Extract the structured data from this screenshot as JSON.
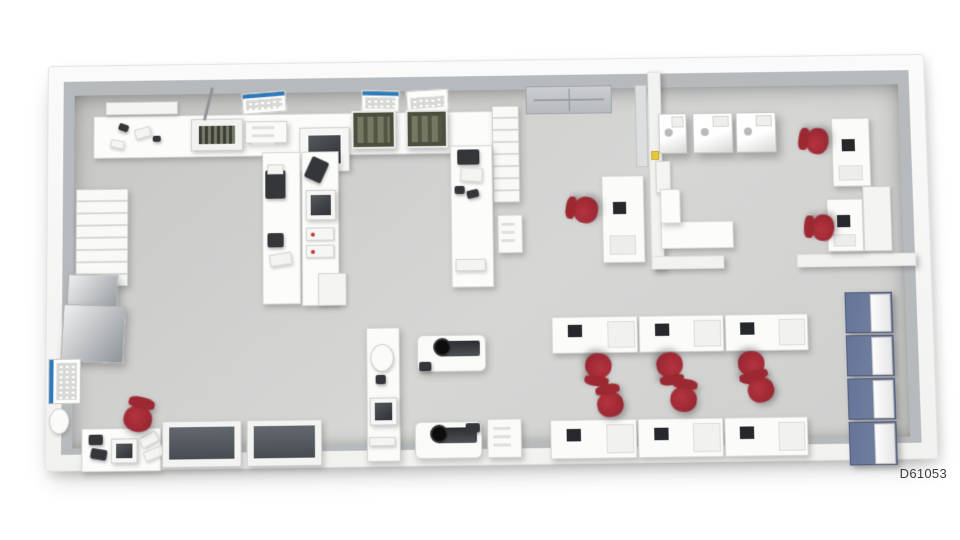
{
  "figure": {
    "id_label": "D61053"
  },
  "palette": {
    "background": "#ffffff",
    "wall_face": "#b7babc",
    "floor_light": "#d6d6d5",
    "floor_dark": "#c7c7c6",
    "chair_red": "#8e222c",
    "locker_blue": "#66749a",
    "poster_blue": "#2f79b8",
    "equipment_dark": "#34363a",
    "machine_olive": "#4c4e3f"
  },
  "floorplan": {
    "items": [
      {
        "n": "top-wall-counter",
        "t": "counter",
        "x": 45,
        "y": 50,
        "w": 400,
        "h": 42
      },
      {
        "n": "wall-shelf",
        "t": "light",
        "x": 57,
        "y": 36,
        "w": 72,
        "h": 13
      },
      {
        "n": "hand-tool",
        "t": "dark",
        "x": 70,
        "y": 58,
        "w": 10,
        "h": 7,
        "r": 20
      },
      {
        "n": "tray-small",
        "t": "light",
        "x": 86,
        "y": 62,
        "w": 16,
        "h": 10,
        "r": -15
      },
      {
        "n": "hand-tool-2",
        "t": "dark",
        "x": 104,
        "y": 70,
        "w": 8,
        "h": 6
      },
      {
        "n": "tray-small-2",
        "t": "light",
        "x": 62,
        "y": 74,
        "w": 14,
        "h": 8,
        "r": 12
      },
      {
        "n": "grill-machine",
        "t": "grill",
        "x": 142,
        "y": 54,
        "w": 52,
        "h": 32
      },
      {
        "n": "stand-pole",
        "t": "pole",
        "x": 158,
        "y": 22,
        "w": 3,
        "h": 34,
        "r": 14
      },
      {
        "n": "tray-box",
        "t": "cart",
        "x": 196,
        "y": 57,
        "w": 42,
        "h": 22
      },
      {
        "n": "steam-cleaner",
        "t": "sqdev",
        "x": 250,
        "y": 64,
        "w": 50,
        "h": 44
      },
      {
        "n": "wall-poster-1",
        "t": "poster",
        "x": 193,
        "y": 28,
        "w": 44,
        "h": 21,
        "r": -4
      },
      {
        "n": "wall-poster-2",
        "t": "poster",
        "x": 312,
        "y": 28,
        "w": 38,
        "h": 22,
        "r": 2
      },
      {
        "n": "wall-poster-3",
        "t": "poster",
        "x": 357,
        "y": 28,
        "w": 42,
        "h": 22,
        "r": -3,
        "c": "transparent"
      },
      {
        "n": "olive-machine-1",
        "t": "olive",
        "x": 302,
        "y": 48,
        "w": 44,
        "h": 38
      },
      {
        "n": "olive-machine-2",
        "t": "olive",
        "x": 356,
        "y": 48,
        "w": 42,
        "h": 38
      },
      {
        "n": "supply-rack",
        "t": "rack",
        "x": 442,
        "y": 45,
        "w": 27,
        "h": 96
      },
      {
        "n": "supply-cart",
        "t": "cart",
        "x": 446,
        "y": 153,
        "w": 25,
        "h": 38
      },
      {
        "n": "entry-door",
        "t": "door",
        "x": 476,
        "y": 26,
        "w": 86,
        "h": 28
      },
      {
        "n": "peninsula-bench-1",
        "t": "bench",
        "x": 213,
        "y": 88,
        "w": 38,
        "h": 150
      },
      {
        "n": "peninsula-bench-2",
        "t": "bench",
        "x": 252,
        "y": 88,
        "w": 37,
        "h": 152
      },
      {
        "n": "press-machine",
        "t": "dark",
        "x": 216,
        "y": 106,
        "w": 20,
        "h": 28
      },
      {
        "n": "press-top",
        "t": "light",
        "x": 218,
        "y": 100,
        "w": 16,
        "h": 10
      },
      {
        "n": "microscope",
        "t": "dark",
        "x": 218,
        "y": 168,
        "w": 16,
        "h": 14
      },
      {
        "n": "work-tray",
        "t": "light",
        "x": 220,
        "y": 188,
        "w": 22,
        "h": 12,
        "r": -8
      },
      {
        "n": "flask-device",
        "t": "sqdev",
        "x": 256,
        "y": 126,
        "w": 30,
        "h": 30
      },
      {
        "n": "small-unit-1",
        "t": "unit",
        "x": 256,
        "y": 163,
        "w": 28,
        "h": 13
      },
      {
        "n": "small-unit-2",
        "t": "unit",
        "x": 256,
        "y": 180,
        "w": 28,
        "h": 13
      },
      {
        "n": "bench-lamp",
        "t": "dark",
        "x": 258,
        "y": 95,
        "w": 18,
        "h": 22,
        "r": 25
      },
      {
        "n": "end-table",
        "t": "light",
        "x": 268,
        "y": 208,
        "w": 28,
        "h": 32
      },
      {
        "n": "peninsula-bench-3",
        "t": "bench",
        "x": 400,
        "y": 84,
        "w": 42,
        "h": 140
      },
      {
        "n": "tablet",
        "t": "dark",
        "x": 407,
        "y": 88,
        "w": 22,
        "h": 15
      },
      {
        "n": "note-sheet",
        "t": "light",
        "x": 410,
        "y": 106,
        "w": 22,
        "h": 14,
        "r": 4
      },
      {
        "n": "tool-small",
        "t": "dark",
        "x": 404,
        "y": 124,
        "w": 10,
        "h": 8
      },
      {
        "n": "tool-small-2",
        "t": "dark",
        "x": 416,
        "y": 128,
        "w": 12,
        "h": 8,
        "r": -12
      },
      {
        "n": "work-tray-2",
        "t": "light",
        "x": 404,
        "y": 196,
        "w": 30,
        "h": 12
      },
      {
        "n": "wall-cabinet-shelves",
        "t": "rack",
        "x": 28,
        "y": 122,
        "w": 52,
        "h": 96
      },
      {
        "n": "steel-cabinet-1",
        "t": "graybox",
        "x": 20,
        "y": 206,
        "w": 50,
        "h": 44,
        "r": 2
      },
      {
        "n": "steel-cabinet-2",
        "t": "graybox",
        "x": 15,
        "y": 236,
        "w": 62,
        "h": 56,
        "r": 3
      },
      {
        "n": "side-wall-poster",
        "t": "posterside",
        "x": 2,
        "y": 288,
        "w": 32,
        "h": 44
      },
      {
        "n": "wall-sink",
        "t": "oval",
        "x": 3,
        "y": 336,
        "w": 20,
        "h": 25
      },
      {
        "n": "corner-workbench",
        "t": "counter",
        "x": 35,
        "y": 356,
        "w": 78,
        "h": 42
      },
      {
        "n": "bench-device",
        "t": "dark",
        "x": 42,
        "y": 362,
        "w": 14,
        "h": 10
      },
      {
        "n": "bench-device-2",
        "t": "dark",
        "x": 44,
        "y": 376,
        "w": 16,
        "h": 10,
        "r": 10
      },
      {
        "n": "bench-sink",
        "t": "sqdev",
        "x": 64,
        "y": 366,
        "w": 26,
        "h": 24
      },
      {
        "n": "keyboard-1",
        "t": "light",
        "x": 92,
        "y": 362,
        "w": 18,
        "h": 11,
        "r": -28
      },
      {
        "n": "keyboard-2",
        "t": "light",
        "x": 96,
        "y": 376,
        "w": 20,
        "h": 10,
        "r": -22
      },
      {
        "n": "corner-chair",
        "t": "chair",
        "x": 74,
        "y": 326,
        "w": 34,
        "h": 36,
        "r": 14
      },
      {
        "n": "darktop-bench-1",
        "t": "darktop",
        "x": 114,
        "y": 350,
        "w": 78,
        "h": 45
      },
      {
        "n": "darktop-bench-2",
        "t": "darktop",
        "x": 197,
        "y": 350,
        "w": 74,
        "h": 45
      },
      {
        "n": "center-console",
        "t": "console",
        "x": 315,
        "y": 262,
        "w": 33,
        "h": 130
      },
      {
        "n": "console-basin",
        "t": "oval",
        "x": 319,
        "y": 278,
        "w": 23,
        "h": 27
      },
      {
        "n": "console-button",
        "t": "dark",
        "x": 324,
        "y": 308,
        "w": 10,
        "h": 9
      },
      {
        "n": "console-screen",
        "t": "sqdev",
        "x": 318,
        "y": 330,
        "w": 27,
        "h": 27
      },
      {
        "n": "console-tray",
        "t": "light",
        "x": 317,
        "y": 368,
        "w": 26,
        "h": 9
      },
      {
        "n": "milling-machine-1",
        "t": "mill",
        "x": 365,
        "y": 270,
        "w": 68,
        "h": 36
      },
      {
        "n": "mill-block-1",
        "t": "dark",
        "x": 367,
        "y": 296,
        "w": 12,
        "h": 9
      },
      {
        "n": "milling-machine-2",
        "t": "mill",
        "x": 362,
        "y": 354,
        "w": 66,
        "h": 36
      },
      {
        "n": "mill-block-2",
        "t": "dark",
        "x": 412,
        "y": 356,
        "w": 14,
        "h": 9
      },
      {
        "n": "mill-cart",
        "t": "cart",
        "x": 433,
        "y": 352,
        "w": 34,
        "h": 38
      },
      {
        "n": "partition-desk",
        "t": "desk",
        "x": 550,
        "y": 116,
        "w": 42,
        "h": 86
      },
      {
        "n": "partition-desk-chair",
        "t": "chair",
        "x": 516,
        "y": 132,
        "w": 30,
        "h": 34,
        "r": -80
      },
      {
        "n": "scan-bench-1",
        "t": "ws",
        "x": 498,
        "y": 254,
        "w": 85,
        "h": 36
      },
      {
        "n": "scan-bench-2",
        "t": "ws",
        "x": 584,
        "y": 254,
        "w": 84,
        "h": 36
      },
      {
        "n": "scan-bench-3",
        "t": "ws",
        "x": 669,
        "y": 254,
        "w": 82,
        "h": 36
      },
      {
        "n": "row-chair-1",
        "t": "chair",
        "x": 527,
        "y": 288,
        "w": 32,
        "h": 34,
        "r": 188
      },
      {
        "n": "row-chair-2",
        "t": "chair",
        "x": 598,
        "y": 288,
        "w": 32,
        "h": 34,
        "r": 172
      },
      {
        "n": "row-chair-3",
        "t": "chair",
        "x": 678,
        "y": 288,
        "w": 32,
        "h": 34,
        "r": 180
      },
      {
        "n": "scan-bench-4",
        "t": "ws",
        "x": 495,
        "y": 354,
        "w": 85,
        "h": 38
      },
      {
        "n": "scan-bench-5",
        "t": "ws",
        "x": 581,
        "y": 354,
        "w": 84,
        "h": 38
      },
      {
        "n": "scan-bench-6",
        "t": "ws",
        "x": 666,
        "y": 354,
        "w": 82,
        "h": 38
      },
      {
        "n": "row-chair-4",
        "t": "chair",
        "x": 538,
        "y": 320,
        "w": 32,
        "h": 34,
        "r": -10
      },
      {
        "n": "row-chair-5",
        "t": "chair",
        "x": 611,
        "y": 316,
        "w": 32,
        "h": 34,
        "r": 8
      },
      {
        "n": "row-chair-6",
        "t": "chair",
        "x": 686,
        "y": 308,
        "w": 32,
        "h": 34,
        "r": -18
      },
      {
        "n": "furnace-1",
        "t": "furnace",
        "x": 608,
        "y": 55,
        "w": 28,
        "h": 40
      },
      {
        "n": "furnace-2",
        "t": "furnace",
        "x": 642,
        "y": 55,
        "w": 40,
        "h": 40
      },
      {
        "n": "furnace-3",
        "t": "furnace",
        "x": 685,
        "y": 55,
        "w": 40,
        "h": 40
      },
      {
        "n": "room-wall-cabinet",
        "t": "light",
        "x": 604,
        "y": 102,
        "w": 15,
        "h": 32
      },
      {
        "n": "room-counter",
        "t": "counter",
        "x": 608,
        "y": 162,
        "w": 72,
        "h": 27
      },
      {
        "n": "room-counter-return",
        "t": "counter",
        "x": 608,
        "y": 130,
        "w": 20,
        "h": 34
      },
      {
        "n": "room-desk-1",
        "t": "desk",
        "x": 780,
        "y": 62,
        "w": 38,
        "h": 68
      },
      {
        "n": "room-chair-1",
        "t": "chair",
        "x": 748,
        "y": 68,
        "w": 30,
        "h": 32,
        "r": -80
      },
      {
        "n": "room-desk-2",
        "t": "desk",
        "x": 773,
        "y": 142,
        "w": 36,
        "h": 52
      },
      {
        "n": "room-chair-2",
        "t": "chair",
        "x": 751,
        "y": 154,
        "w": 30,
        "h": 32,
        "r": -85
      },
      {
        "n": "room-cabinet",
        "t": "light",
        "x": 809,
        "y": 130,
        "w": 28,
        "h": 64
      },
      {
        "n": "warning-label",
        "t": "yellow",
        "x": 600,
        "y": 92,
        "w": 8,
        "h": 9
      },
      {
        "n": "locker-1",
        "t": "locker",
        "x": 788,
        "y": 234,
        "w": 47,
        "h": 40
      },
      {
        "n": "locker-2",
        "t": "locker",
        "x": 788,
        "y": 276,
        "w": 47,
        "h": 40
      },
      {
        "n": "locker-3",
        "t": "locker",
        "x": 788,
        "y": 318,
        "w": 47,
        "h": 40
      },
      {
        "n": "locker-4",
        "t": "locker",
        "x": 788,
        "y": 360,
        "w": 47,
        "h": 42
      }
    ]
  }
}
